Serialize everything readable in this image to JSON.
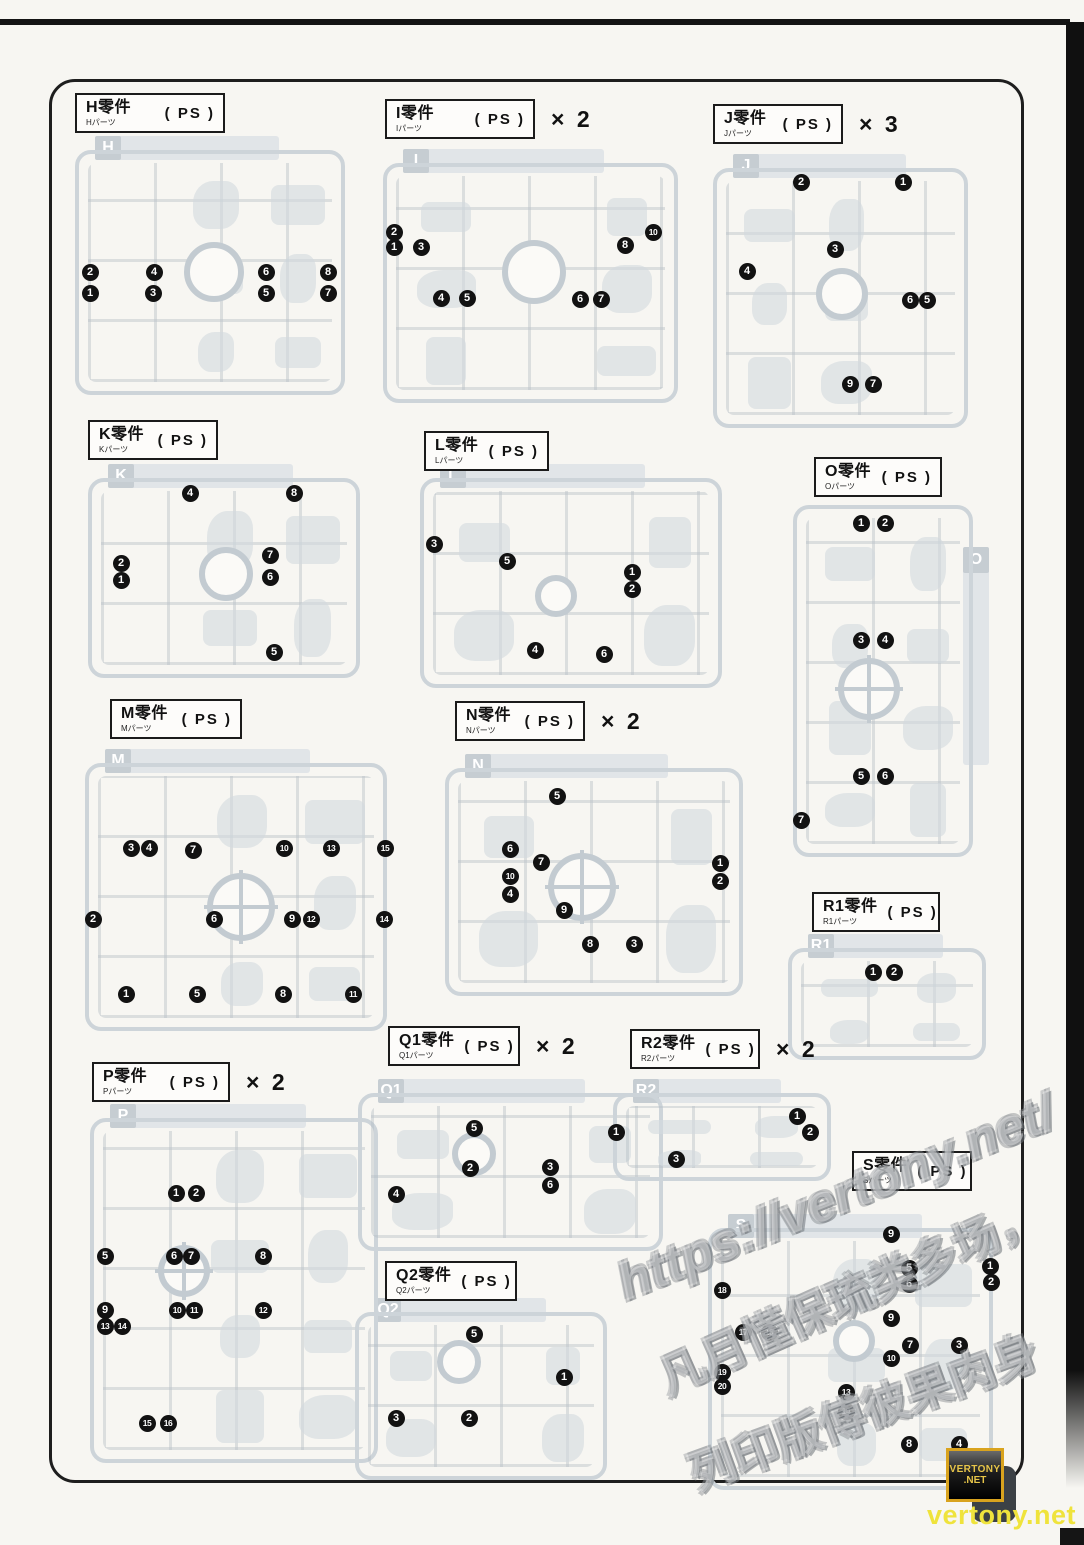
{
  "watermarks": {
    "url": "https://vertony.net/",
    "cn_line1": "凡月懂保琉类多场，",
    "cn_line2": "列印版傅彼果肉身",
    "badge_line1": "VERTONY",
    "badge_line2": ".NET",
    "footer": "vertony.net"
  },
  "runners": [
    {
      "id": "H",
      "title": "H零件",
      "sub": "Hパーツ",
      "material": "( PS )",
      "multiplier": "",
      "label": {
        "x": 75,
        "y": 93,
        "w": 150
      },
      "frame": {
        "x": 75,
        "y": 150,
        "w": 270,
        "h": 245
      },
      "tab": "top",
      "ring": {
        "cx": 210,
        "cy": 268,
        "r": 30,
        "cross": false
      },
      "callouts": [
        {
          "n": "2",
          "x": 86,
          "y": 268
        },
        {
          "n": "4",
          "x": 150,
          "y": 268
        },
        {
          "n": "6",
          "x": 262,
          "y": 268
        },
        {
          "n": "8",
          "x": 324,
          "y": 268
        },
        {
          "n": "1",
          "x": 86,
          "y": 289
        },
        {
          "n": "3",
          "x": 149,
          "y": 289
        },
        {
          "n": "5",
          "x": 262,
          "y": 289
        },
        {
          "n": "7",
          "x": 324,
          "y": 289
        }
      ]
    },
    {
      "id": "I",
      "title": "I零件",
      "sub": "Iパーツ",
      "material": "( PS )",
      "multiplier": "× 2",
      "label": {
        "x": 385,
        "y": 99,
        "w": 150
      },
      "frame": {
        "x": 383,
        "y": 163,
        "w": 295,
        "h": 240
      },
      "tab": "top",
      "ring": {
        "cx": 530,
        "cy": 268,
        "r": 32,
        "cross": false
      },
      "callouts": [
        {
          "n": "2",
          "x": 390,
          "y": 228
        },
        {
          "n": "1",
          "x": 390,
          "y": 243
        },
        {
          "n": "3",
          "x": 417,
          "y": 243
        },
        {
          "n": "10",
          "x": 649,
          "y": 228
        },
        {
          "n": "8",
          "x": 621,
          "y": 241
        },
        {
          "n": "4",
          "x": 437,
          "y": 294
        },
        {
          "n": "5",
          "x": 463,
          "y": 294
        },
        {
          "n": "6",
          "x": 576,
          "y": 295
        },
        {
          "n": "7",
          "x": 597,
          "y": 295
        }
      ]
    },
    {
      "id": "J",
      "title": "J零件",
      "sub": "Jパーツ",
      "material": "( PS )",
      "multiplier": "× 3",
      "label": {
        "x": 713,
        "y": 104,
        "w": 130
      },
      "frame": {
        "x": 713,
        "y": 168,
        "w": 255,
        "h": 260
      },
      "tab": "top",
      "ring": {
        "cx": 838,
        "cy": 290,
        "r": 26,
        "cross": false
      },
      "callouts": [
        {
          "n": "2",
          "x": 797,
          "y": 178
        },
        {
          "n": "1",
          "x": 899,
          "y": 178
        },
        {
          "n": "3",
          "x": 831,
          "y": 245
        },
        {
          "n": "4",
          "x": 743,
          "y": 267
        },
        {
          "n": "6",
          "x": 906,
          "y": 296
        },
        {
          "n": "5",
          "x": 923,
          "y": 296
        },
        {
          "n": "9",
          "x": 846,
          "y": 380
        },
        {
          "n": "7",
          "x": 869,
          "y": 380
        }
      ]
    },
    {
      "id": "K",
      "title": "K零件",
      "sub": "Kパーツ",
      "material": "( PS )",
      "multiplier": "",
      "label": {
        "x": 88,
        "y": 420,
        "w": 130
      },
      "frame": {
        "x": 88,
        "y": 478,
        "w": 272,
        "h": 200
      },
      "tab": "top",
      "ring": {
        "cx": 222,
        "cy": 570,
        "r": 27,
        "cross": false
      },
      "callouts": [
        {
          "n": "4",
          "x": 186,
          "y": 489
        },
        {
          "n": "8",
          "x": 290,
          "y": 489
        },
        {
          "n": "2",
          "x": 117,
          "y": 559
        },
        {
          "n": "1",
          "x": 117,
          "y": 576
        },
        {
          "n": "7",
          "x": 266,
          "y": 551
        },
        {
          "n": "6",
          "x": 266,
          "y": 573
        },
        {
          "n": "5",
          "x": 270,
          "y": 648
        }
      ]
    },
    {
      "id": "L",
      "title": "L零件",
      "sub": "Lパーツ",
      "material": "( PS )",
      "multiplier": "",
      "label": {
        "x": 424,
        "y": 431,
        "w": 125
      },
      "frame": {
        "x": 420,
        "y": 478,
        "w": 302,
        "h": 210
      },
      "tab": "top",
      "ring": {
        "cx": 552,
        "cy": 592,
        "r": 21,
        "cross": false
      },
      "callouts": [
        {
          "n": "3",
          "x": 430,
          "y": 540
        },
        {
          "n": "5",
          "x": 503,
          "y": 557
        },
        {
          "n": "1",
          "x": 628,
          "y": 568
        },
        {
          "n": "2",
          "x": 628,
          "y": 585
        },
        {
          "n": "4",
          "x": 531,
          "y": 646
        },
        {
          "n": "6",
          "x": 600,
          "y": 650
        }
      ]
    },
    {
      "id": "O",
      "title": "O零件",
      "sub": "Oパーツ",
      "material": "( PS )",
      "multiplier": "",
      "label": {
        "x": 814,
        "y": 457,
        "w": 128
      },
      "frame": {
        "x": 793,
        "y": 505,
        "w": 180,
        "h": 352
      },
      "tab": "right",
      "ring": {
        "cx": 865,
        "cy": 685,
        "r": 31,
        "cross": true
      },
      "callouts": [
        {
          "n": "1",
          "x": 857,
          "y": 519
        },
        {
          "n": "2",
          "x": 881,
          "y": 519
        },
        {
          "n": "3",
          "x": 857,
          "y": 636
        },
        {
          "n": "4",
          "x": 881,
          "y": 636
        },
        {
          "n": "5",
          "x": 857,
          "y": 772
        },
        {
          "n": "6",
          "x": 881,
          "y": 772
        },
        {
          "n": "7",
          "x": 797,
          "y": 816
        }
      ]
    },
    {
      "id": "M",
      "title": "M零件",
      "sub": "Mパーツ",
      "material": "( PS )",
      "multiplier": "",
      "label": {
        "x": 110,
        "y": 699,
        "w": 132
      },
      "frame": {
        "x": 85,
        "y": 763,
        "w": 302,
        "h": 268
      },
      "tab": "top",
      "ring": {
        "cx": 237,
        "cy": 903,
        "r": 34,
        "cross": true
      },
      "callouts": [
        {
          "n": "3",
          "x": 127,
          "y": 844
        },
        {
          "n": "4",
          "x": 145,
          "y": 844
        },
        {
          "n": "7",
          "x": 189,
          "y": 846
        },
        {
          "n": "10",
          "x": 280,
          "y": 844
        },
        {
          "n": "13",
          "x": 327,
          "y": 844
        },
        {
          "n": "15",
          "x": 381,
          "y": 844
        },
        {
          "n": "2",
          "x": 89,
          "y": 915
        },
        {
          "n": "6",
          "x": 210,
          "y": 915
        },
        {
          "n": "9",
          "x": 288,
          "y": 915
        },
        {
          "n": "12",
          "x": 307,
          "y": 915
        },
        {
          "n": "14",
          "x": 380,
          "y": 915
        },
        {
          "n": "1",
          "x": 122,
          "y": 990
        },
        {
          "n": "5",
          "x": 193,
          "y": 990
        },
        {
          "n": "8",
          "x": 279,
          "y": 990
        },
        {
          "n": "11",
          "x": 349,
          "y": 990
        }
      ]
    },
    {
      "id": "N",
      "title": "N零件",
      "sub": "Nパーツ",
      "material": "( PS )",
      "multiplier": "× 2",
      "label": {
        "x": 455,
        "y": 701,
        "w": 130
      },
      "frame": {
        "x": 445,
        "y": 768,
        "w": 298,
        "h": 228
      },
      "tab": "top",
      "ring": {
        "cx": 578,
        "cy": 883,
        "r": 34,
        "cross": true
      },
      "callouts": [
        {
          "n": "5",
          "x": 553,
          "y": 792
        },
        {
          "n": "6",
          "x": 506,
          "y": 845
        },
        {
          "n": "7",
          "x": 537,
          "y": 858
        },
        {
          "n": "10",
          "x": 506,
          "y": 872
        },
        {
          "n": "4",
          "x": 506,
          "y": 890
        },
        {
          "n": "1",
          "x": 716,
          "y": 859
        },
        {
          "n": "2",
          "x": 716,
          "y": 877
        },
        {
          "n": "9",
          "x": 560,
          "y": 906
        },
        {
          "n": "8",
          "x": 586,
          "y": 940
        },
        {
          "n": "3",
          "x": 630,
          "y": 940
        }
      ]
    },
    {
      "id": "R1",
      "title": "R1零件",
      "sub": "R1パーツ",
      "material": "( PS )",
      "multiplier": "",
      "label": {
        "x": 812,
        "y": 892,
        "w": 128
      },
      "frame": {
        "x": 788,
        "y": 948,
        "w": 198,
        "h": 112
      },
      "tab": "top",
      "ring": null,
      "callouts": [
        {
          "n": "1",
          "x": 869,
          "y": 968
        },
        {
          "n": "2",
          "x": 890,
          "y": 968
        }
      ]
    },
    {
      "id": "P",
      "title": "P零件",
      "sub": "Pパーツ",
      "material": "( PS )",
      "multiplier": "× 2",
      "label": {
        "x": 92,
        "y": 1062,
        "w": 138
      },
      "frame": {
        "x": 90,
        "y": 1118,
        "w": 288,
        "h": 345
      },
      "tab": "top",
      "ring": {
        "cx": 180,
        "cy": 1267,
        "r": 26,
        "cross": true
      },
      "callouts": [
        {
          "n": "1",
          "x": 172,
          "y": 1189
        },
        {
          "n": "2",
          "x": 192,
          "y": 1189
        },
        {
          "n": "5",
          "x": 101,
          "y": 1252
        },
        {
          "n": "6",
          "x": 170,
          "y": 1252
        },
        {
          "n": "7",
          "x": 187,
          "y": 1252
        },
        {
          "n": "8",
          "x": 259,
          "y": 1252
        },
        {
          "n": "9",
          "x": 101,
          "y": 1306
        },
        {
          "n": "10",
          "x": 173,
          "y": 1306
        },
        {
          "n": "11",
          "x": 190,
          "y": 1306
        },
        {
          "n": "12",
          "x": 259,
          "y": 1306
        },
        {
          "n": "13",
          "x": 101,
          "y": 1322
        },
        {
          "n": "14",
          "x": 118,
          "y": 1322
        },
        {
          "n": "15",
          "x": 143,
          "y": 1419
        },
        {
          "n": "16",
          "x": 164,
          "y": 1419
        }
      ]
    },
    {
      "id": "Q1",
      "title": "Q1零件",
      "sub": "Q1パーツ",
      "material": "( PS )",
      "multiplier": "× 2",
      "label": {
        "x": 388,
        "y": 1026,
        "w": 132
      },
      "frame": {
        "x": 358,
        "y": 1093,
        "w": 305,
        "h": 158
      },
      "tab": "top",
      "ring": {
        "cx": 470,
        "cy": 1150,
        "r": 22,
        "cross": false
      },
      "callouts": [
        {
          "n": "5",
          "x": 470,
          "y": 1124
        },
        {
          "n": "1",
          "x": 612,
          "y": 1128
        },
        {
          "n": "2",
          "x": 466,
          "y": 1164
        },
        {
          "n": "3",
          "x": 546,
          "y": 1163
        },
        {
          "n": "6",
          "x": 546,
          "y": 1181
        },
        {
          "n": "4",
          "x": 392,
          "y": 1190
        }
      ]
    },
    {
      "id": "R2",
      "title": "R2零件",
      "sub": "R2パーツ",
      "material": "( PS )",
      "multiplier": "× 2",
      "label": {
        "x": 630,
        "y": 1029,
        "w": 130
      },
      "frame": {
        "x": 613,
        "y": 1093,
        "w": 218,
        "h": 88
      },
      "tab": "top",
      "ring": null,
      "callouts": [
        {
          "n": "1",
          "x": 793,
          "y": 1112
        },
        {
          "n": "2",
          "x": 806,
          "y": 1128
        },
        {
          "n": "3",
          "x": 672,
          "y": 1155
        }
      ]
    },
    {
      "id": "S",
      "title": "S零件",
      "sub": "Sパーツ",
      "material": "( PS )",
      "multiplier": "",
      "label": {
        "x": 852,
        "y": 1151,
        "w": 120
      },
      "frame": {
        "x": 708,
        "y": 1228,
        "w": 285,
        "h": 262
      },
      "tab": "top",
      "ring": {
        "cx": 850,
        "cy": 1337,
        "r": 21,
        "cross": false
      },
      "callouts": [
        {
          "n": "9",
          "x": 887,
          "y": 1230
        },
        {
          "n": "5",
          "x": 905,
          "y": 1264
        },
        {
          "n": "6",
          "x": 905,
          "y": 1280
        },
        {
          "n": "1",
          "x": 986,
          "y": 1262
        },
        {
          "n": "2",
          "x": 987,
          "y": 1278
        },
        {
          "n": "18",
          "x": 718,
          "y": 1286
        },
        {
          "n": "9",
          "x": 887,
          "y": 1314
        },
        {
          "n": "17",
          "x": 739,
          "y": 1328
        },
        {
          "n": "16",
          "x": 765,
          "y": 1328
        },
        {
          "n": "7",
          "x": 906,
          "y": 1341
        },
        {
          "n": "3",
          "x": 955,
          "y": 1341
        },
        {
          "n": "10",
          "x": 887,
          "y": 1354
        },
        {
          "n": "19",
          "x": 718,
          "y": 1368
        },
        {
          "n": "20",
          "x": 718,
          "y": 1382
        },
        {
          "n": "13",
          "x": 842,
          "y": 1388
        },
        {
          "n": "14",
          "x": 842,
          "y": 1407
        },
        {
          "n": "8",
          "x": 905,
          "y": 1440
        },
        {
          "n": "4",
          "x": 955,
          "y": 1440
        }
      ]
    },
    {
      "id": "Q2",
      "title": "Q2零件",
      "sub": "Q2パーツ",
      "material": "( PS )",
      "multiplier": "",
      "label": {
        "x": 385,
        "y": 1261,
        "w": 132
      },
      "frame": {
        "x": 355,
        "y": 1312,
        "w": 252,
        "h": 168
      },
      "tab": "top",
      "ring": {
        "cx": 455,
        "cy": 1358,
        "r": 22,
        "cross": false
      },
      "callouts": [
        {
          "n": "5",
          "x": 470,
          "y": 1330
        },
        {
          "n": "1",
          "x": 560,
          "y": 1373
        },
        {
          "n": "3",
          "x": 392,
          "y": 1414
        },
        {
          "n": "2",
          "x": 465,
          "y": 1414
        }
      ]
    }
  ]
}
